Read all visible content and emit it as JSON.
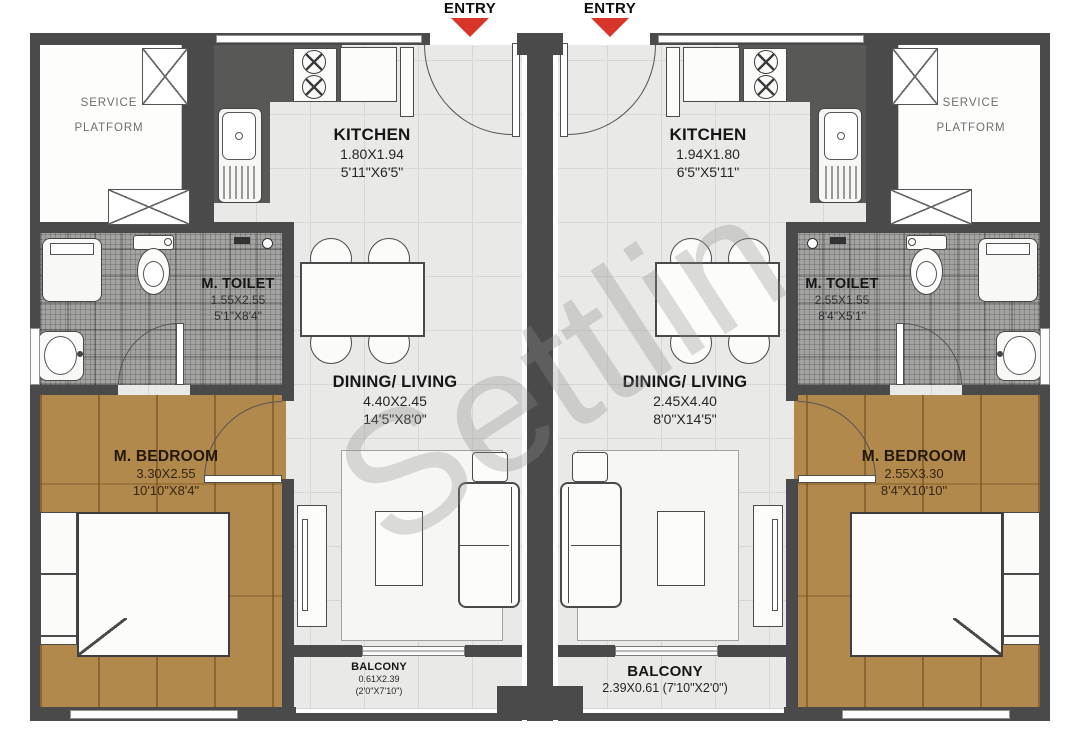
{
  "watermark": "Settlin",
  "colors": {
    "wall": "#4a4a4a",
    "wood_floor": "#b2894d",
    "entry_arrow_red": "#d7342a"
  },
  "units": [
    {
      "entry": "ENTRY",
      "service_platform": {
        "line1": "SERVICE",
        "line2": "PLATFORM"
      },
      "kitchen": {
        "name": "KITCHEN",
        "dim_m": "1.80X1.94",
        "dim_ft": "5'11\"X6'5\""
      },
      "toilet": {
        "name": "M. TOILET",
        "dim_m": "1.55X2.55",
        "dim_ft": "5'1\"X8'4\""
      },
      "dining": {
        "name": "DINING/ LIVING",
        "dim_m": "4.40X2.45",
        "dim_ft": "14'5\"X8'0\""
      },
      "bedroom": {
        "name": "M. BEDROOM",
        "dim_m": "3.30X2.55",
        "dim_ft": "10'10\"X8'4\""
      },
      "balcony": {
        "name": "BALCONY",
        "line2": "0.61X2.39",
        "line3": "(2'0\"X7'10\")"
      }
    },
    {
      "entry": "ENTRY",
      "service_platform": {
        "line1": "SERVICE",
        "line2": "PLATFORM"
      },
      "kitchen": {
        "name": "KITCHEN",
        "dim_m": "1.94X1.80",
        "dim_ft": "6'5\"X5'11\""
      },
      "toilet": {
        "name": "M. TOILET",
        "dim_m": "2.55X1.55",
        "dim_ft": "8'4\"X5'1\""
      },
      "dining": {
        "name": "DINING/ LIVING",
        "dim_m": "2.45X4.40",
        "dim_ft": "8'0\"X14'5\""
      },
      "bedroom": {
        "name": "M. BEDROOM",
        "dim_m": "2.55X3.30",
        "dim_ft": "8'4\"X10'10\""
      },
      "balcony": {
        "name": "BALCONY",
        "line2": "2.39X0.61 (7'10\"X2'0\")"
      }
    }
  ]
}
